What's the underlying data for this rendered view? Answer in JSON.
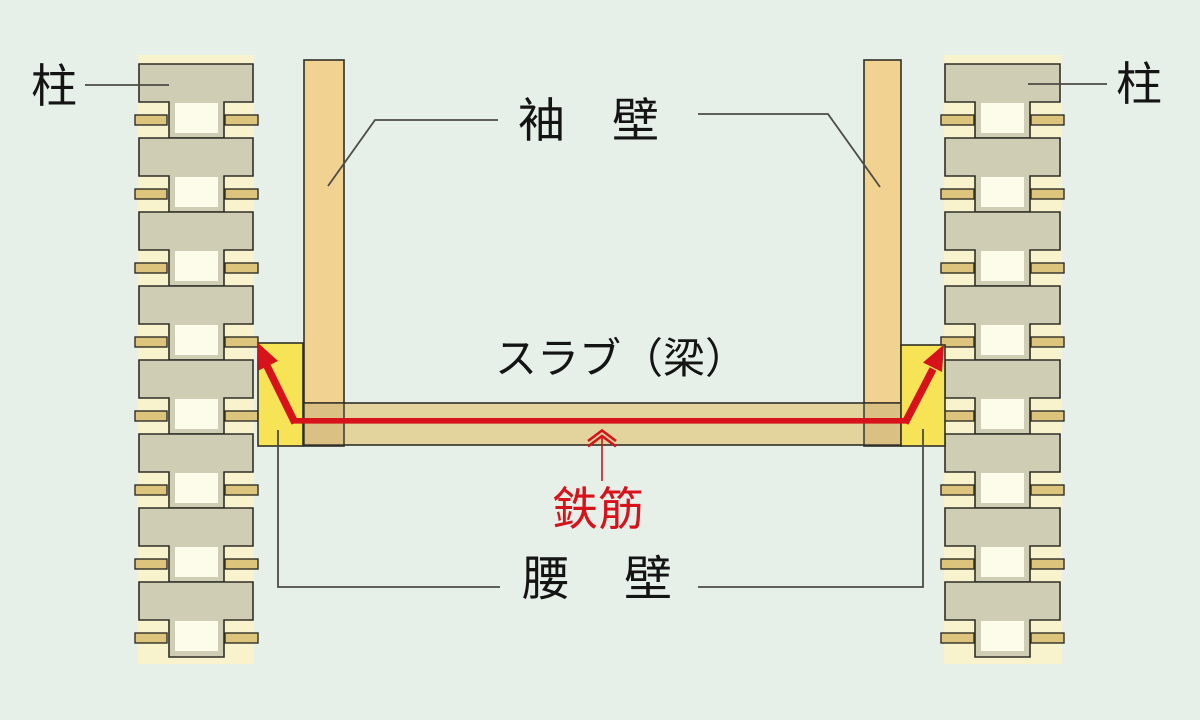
{
  "labels": {
    "pillar_left": "柱",
    "pillar_right": "柱",
    "sleeve_wall": "袖　壁",
    "slab_beam": "スラブ（梁）",
    "rebar": "鉄筋",
    "waist_wall": "腰　壁"
  },
  "colors": {
    "background": "#e7f0e8",
    "outline": "#2f2f26",
    "leader_line": "#4c4c46",
    "text_black": "#141414",
    "rebar_red": "#d7121b",
    "column_block": "#cfceb4",
    "column_backing": "#f8f3cc",
    "column_joint_white": "#fdfbe9",
    "column_tab": "#ddc47d",
    "sleeve_wall": "#f1d291",
    "slab": "#e3d39c",
    "slab_wall_overlap": "#dbc083",
    "waist_wall_yellow": "#f6e456"
  }
}
